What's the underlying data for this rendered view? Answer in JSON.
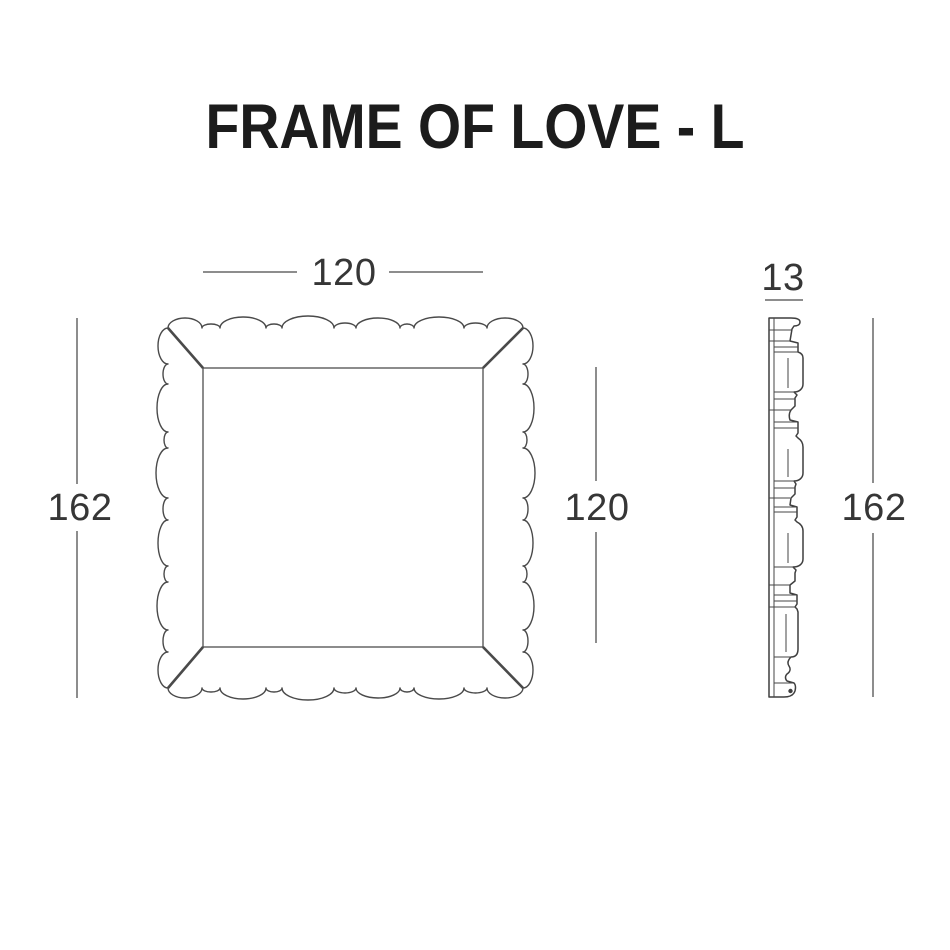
{
  "title": "FRAME OF LOVE - L",
  "colors": {
    "background": "#ffffff",
    "drawing_line": "#4a4a4a",
    "dimension_line": "#8d8d8d",
    "dimension_text": "#363636",
    "title_text": "#1c1c1c"
  },
  "front_view": {
    "dim_top_width": "120",
    "dim_left_height": "162",
    "dim_right_inner_height": "120"
  },
  "side_view": {
    "dim_top_depth": "13",
    "dim_right_height": "162"
  }
}
